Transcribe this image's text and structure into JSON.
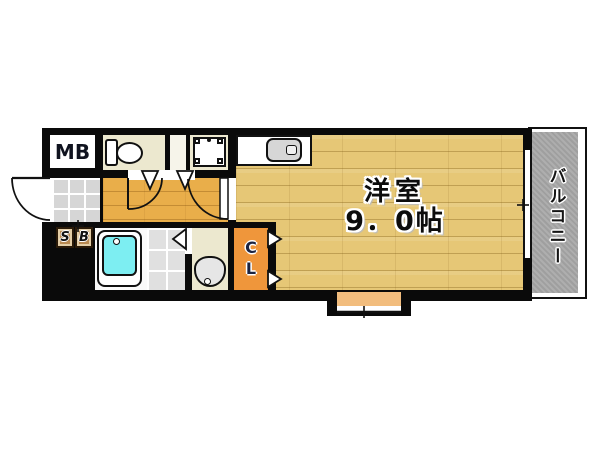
{
  "labels": {
    "meter_box": "MB",
    "shoe_box_s": "S",
    "shoe_box_b": "B",
    "closet": "CL",
    "room_name": "洋室",
    "room_size": "9．0帖",
    "balcony": "バルコニー"
  },
  "colors": {
    "wall": "#0a0a0a",
    "room_floor": "#e6c776",
    "hallway_floor": "#e9ae4a",
    "service_floor": "#ece8cf",
    "closet": "#ef963b",
    "shoe_box": "#b98a52",
    "bathtub": "#7deef2",
    "balcony_floor": "#a9a9a9",
    "bay_window": "#f2bd7e",
    "entrance_tile": "#d6d6d6"
  }
}
